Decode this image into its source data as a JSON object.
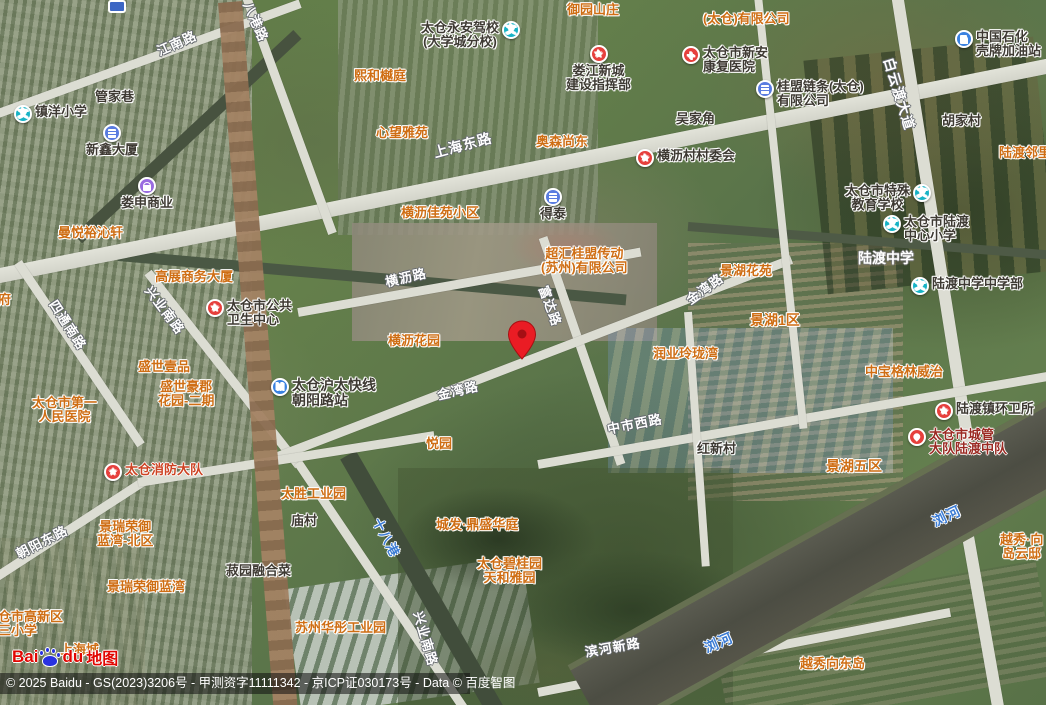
{
  "app": "baidu-maps-satellite",
  "attribution": {
    "text": "© 2025 Baidu - GS(2023)3206号 - 甲测资字11111342 - 京ICP证030173号 - Data © 百度智图"
  },
  "logo": {
    "bai": "Bai",
    "du": "du",
    "map_word": "地图"
  },
  "colors": {
    "poi_orange": "#cf6e14",
    "poi_dark": "#3e3a33",
    "water_blue": "#3c7cd4",
    "icon_red": "#e6403d",
    "icon_teal": "#17b3c6",
    "icon_blue": "#3b82e0",
    "icon_purple": "#9a6ce0",
    "pin_red": "#ea1c24"
  },
  "pin": {
    "x": 507,
    "y": 320
  },
  "labels": [
    {
      "name": "jiangnan-road-label",
      "text": "江南路",
      "type": "road",
      "x": 155,
      "y": 46,
      "rotate": -24
    },
    {
      "name": "bagang-road-label",
      "text": "八港路",
      "type": "road",
      "x": 253,
      "y": 0,
      "rotate": 66
    },
    {
      "name": "shanghai-east-road-label",
      "text": "上海东路",
      "type": "road",
      "x": 432,
      "y": 146,
      "rotate": -15,
      "size": 14
    },
    {
      "name": "baiyundu-avenue-label",
      "text": "白云渡大道",
      "type": "road",
      "x": 895,
      "y": 56,
      "rotate": 73,
      "size": 14
    },
    {
      "name": "sitong-south-road-label",
      "text": "四通南路",
      "type": "road",
      "x": 58,
      "y": 298,
      "rotate": 57
    },
    {
      "name": "xingye-south-road-label",
      "text": "兴业南路",
      "type": "road",
      "x": 153,
      "y": 284,
      "rotate": 53
    },
    {
      "name": "hengli-road-label",
      "text": "横沥路",
      "type": "road",
      "x": 384,
      "y": 276,
      "rotate": -13
    },
    {
      "name": "fuda-road-label",
      "text": "富达路",
      "type": "road",
      "x": 549,
      "y": 284,
      "rotate": 70
    },
    {
      "name": "jinwan-road-west-label",
      "text": "金湾路",
      "type": "road",
      "x": 436,
      "y": 389,
      "rotate": -13
    },
    {
      "name": "jinwan-road-east-label",
      "text": "金湾路",
      "type": "road",
      "x": 684,
      "y": 296,
      "rotate": -36
    },
    {
      "name": "zhongshi-west-road-label",
      "text": "中市西路",
      "type": "road",
      "x": 606,
      "y": 423,
      "rotate": -11
    },
    {
      "name": "chaoyang-east-road-label",
      "text": "朝阳东路",
      "type": "road",
      "x": 14,
      "y": 549,
      "rotate": -27
    },
    {
      "name": "xingye-south-road-2-label",
      "text": "兴业南路",
      "type": "road",
      "x": 424,
      "y": 610,
      "rotate": 74
    },
    {
      "name": "binhe-new-road-label",
      "text": "滨河新路",
      "type": "road",
      "x": 584,
      "y": 646,
      "rotate": -10
    },
    {
      "name": "shibagang-waterway-label",
      "text": "十八港",
      "type": "water",
      "x": 382,
      "y": 516,
      "rotate": 62
    },
    {
      "name": "liuhe-river-east-label",
      "text": "浏河",
      "type": "water",
      "x": 930,
      "y": 516,
      "rotate": -25,
      "size": 14
    },
    {
      "name": "liuhe-river-west-label",
      "text": "浏河",
      "type": "water",
      "x": 702,
      "y": 642,
      "rotate": -23,
      "size": 14
    },
    {
      "name": "yuyuan-shanzhuang",
      "text": "御园山庄",
      "type": "poi-orange",
      "x": 567,
      "y": 3
    },
    {
      "name": "taicang-co-ltd",
      "text": "(太仓)有限公司",
      "type": "poi-orange",
      "x": 703,
      "y": 12
    },
    {
      "name": "xihe-yueting",
      "text": "熙和樾庭",
      "type": "poi-orange",
      "x": 354,
      "y": 69
    },
    {
      "name": "xinwang-yayuan",
      "text": "心望雅苑",
      "type": "poi-orange",
      "x": 376,
      "y": 126
    },
    {
      "name": "aosen-shangdong",
      "text": "奥森尚东",
      "type": "poi-orange",
      "x": 536,
      "y": 135
    },
    {
      "name": "hengli-jiayuan-block",
      "text": "横沥佳苑小区",
      "type": "poi-orange",
      "x": 401,
      "y": 206
    },
    {
      "name": "chaohui-guimeng-company",
      "text": "超汇桂盟传动\n(苏州)有限公司",
      "type": "poi-orange",
      "x": 541,
      "y": 247,
      "align": "center"
    },
    {
      "name": "hengli-garden",
      "text": "横沥花园",
      "type": "poi-orange",
      "x": 388,
      "y": 334
    },
    {
      "name": "manyue-yuqinxuan",
      "text": "曼悦裕沁轩",
      "type": "poi-orange",
      "x": 58,
      "y": 226
    },
    {
      "name": "gaozhan-business-tower",
      "text": "高展商务大厦",
      "type": "poi-orange",
      "x": 155,
      "y": 270
    },
    {
      "name": "shengshi-yipin",
      "text": "盛世壹品",
      "type": "poi-orange",
      "x": 138,
      "y": 360
    },
    {
      "name": "shengshi-haojun-garden",
      "text": "盛世豪郡\n花园-二期",
      "type": "poi-orange",
      "x": 158,
      "y": 380,
      "align": "center"
    },
    {
      "name": "taicang-first-hospital",
      "text": "太仓市第一\n人民医院",
      "type": "poi-orange",
      "x": 32,
      "y": 396,
      "align": "center"
    },
    {
      "name": "jinghu-huayuan",
      "text": "景湖花苑",
      "type": "poi-orange",
      "x": 720,
      "y": 264
    },
    {
      "name": "jinghu-zone-1",
      "text": "景湖1区",
      "type": "poi-orange",
      "x": 750,
      "y": 313,
      "size": 14
    },
    {
      "name": "runye-linglongwan",
      "text": "润业玲珑湾",
      "type": "poi-orange",
      "x": 653,
      "y": 347
    },
    {
      "name": "zhongbao-greenwich",
      "text": "中宝格林威治",
      "type": "poi-orange",
      "x": 865,
      "y": 365
    },
    {
      "name": "jinghu-zone-5",
      "text": "景湖五区",
      "type": "poi-orange",
      "x": 826,
      "y": 459,
      "size": 14
    },
    {
      "name": "yueyuan",
      "text": "悦园",
      "type": "poi-orange",
      "x": 426,
      "y": 437
    },
    {
      "name": "taisheng-industrial-park",
      "text": "太胜工业园",
      "type": "poi-orange",
      "x": 281,
      "y": 487
    },
    {
      "name": "chengfa-dingsheng-huating",
      "text": "城发·鼎盛华庭",
      "type": "poi-orange",
      "x": 436,
      "y": 518
    },
    {
      "name": "taicang-biguiyuan",
      "text": "太仓碧桂园\n天和雅园",
      "type": "poi-orange",
      "x": 477,
      "y": 557,
      "align": "center"
    },
    {
      "name": "suzhou-huatong-industrial-park",
      "text": "苏州华彤工业园",
      "type": "poi-orange",
      "x": 295,
      "y": 621
    },
    {
      "name": "jingrui-lanwan-north",
      "text": "景瑞荣御\n蓝湾-北区",
      "type": "poi-orange",
      "x": 97,
      "y": 520,
      "align": "center"
    },
    {
      "name": "jingrui-lanwan",
      "text": "景瑞荣御蓝湾",
      "type": "poi-orange",
      "x": 107,
      "y": 580
    },
    {
      "name": "gaoxin-third-primary-school",
      "text": "太仓市高新区\n第三小学",
      "type": "poi-orange",
      "x": -15,
      "y": 610
    },
    {
      "name": "shanghai-cheng",
      "text": "上海城",
      "type": "poi-orange",
      "x": 60,
      "y": 643
    },
    {
      "name": "ludu-linli",
      "text": "陆渡邻里",
      "type": "poi-orange",
      "x": 999,
      "y": 146
    },
    {
      "name": "yuexiu-daoyundi",
      "text": "越秀·向\n岛云邸",
      "type": "poi-orange",
      "x": 1000,
      "y": 533,
      "align": "center"
    },
    {
      "name": "yuexiu-xiangdongdao",
      "text": "越秀向东岛",
      "type": "poi-orange",
      "x": 800,
      "y": 657
    },
    {
      "name": "fu-partial-label",
      "text": "府",
      "type": "poi-orange",
      "x": -2,
      "y": 293
    },
    {
      "name": "taicang-fire-brigade",
      "text": "太仓消防大队",
      "type": "poi-redorange",
      "x": 104,
      "y": 463,
      "icon": "fire",
      "icon_pos": "left"
    },
    {
      "name": "guanjia-lane",
      "text": "管家巷",
      "type": "poi-dark",
      "x": 95,
      "y": 90
    },
    {
      "name": "zhenyang-primary-school",
      "text": "镇洋小学",
      "type": "poi-dark",
      "x": 14,
      "y": 105,
      "icon": "school",
      "icon_pos": "left"
    },
    {
      "name": "xinxin-tower",
      "text": "新鑫大厦",
      "type": "poi-dark",
      "x": 86,
      "y": 124,
      "icon": "building",
      "icon_pos": "top",
      "align": "center"
    },
    {
      "name": "loushen-commercial",
      "text": "娄申商业",
      "type": "poi-dark",
      "x": 121,
      "y": 177,
      "icon": "shop",
      "icon_pos": "top",
      "align": "center"
    },
    {
      "name": "wujia-jiao",
      "text": "吴家角",
      "type": "poi-dark",
      "x": 676,
      "y": 112
    },
    {
      "name": "hujia-village",
      "text": "胡家村",
      "type": "poi-dark",
      "x": 942,
      "y": 114
    },
    {
      "name": "miao-village",
      "text": "庙村",
      "type": "poi-dark",
      "x": 291,
      "y": 514
    },
    {
      "name": "hongxin-village",
      "text": "红新村",
      "type": "poi-dark",
      "x": 697,
      "y": 442
    },
    {
      "name": "shuyuan-ronghecai",
      "text": "菽园融合菜",
      "type": "poi-dark",
      "x": 226,
      "y": 564
    },
    {
      "name": "taicang-yongan-driving-school",
      "text": "太仓永安驾校\n(大学城分校)",
      "type": "poi-dark",
      "x": 421,
      "y": 21,
      "icon": "school",
      "icon_pos": "right",
      "align": "center"
    },
    {
      "name": "loujiang-new-city-hq",
      "text": "娄江新城\n建设指挥部",
      "type": "poi-dark",
      "x": 566,
      "y": 45,
      "icon": "star",
      "icon_pos": "top",
      "align": "center"
    },
    {
      "name": "xinan-rehab-hospital",
      "text": "太仓市新安\n康复医院",
      "type": "poi-dark",
      "x": 682,
      "y": 46,
      "icon": "hospital",
      "icon_pos": "left"
    },
    {
      "name": "guimeng-chain-company",
      "text": "桂盟链条(太仓)\n有限公司",
      "type": "poi-dark",
      "x": 756,
      "y": 80,
      "icon": "building",
      "icon_pos": "left"
    },
    {
      "name": "sinopec-shell-gas-station",
      "text": "中国石化\n壳牌加油站",
      "type": "poi-dark",
      "x": 955,
      "y": 30,
      "icon": "gas",
      "icon_pos": "left"
    },
    {
      "name": "hengli-village-committee",
      "text": "横沥村村委会",
      "type": "poi-dark",
      "x": 636,
      "y": 149,
      "icon": "star",
      "icon_pos": "left"
    },
    {
      "name": "detai",
      "text": "得泰",
      "type": "poi-dark",
      "x": 540,
      "y": 188,
      "icon": "building",
      "icon_pos": "top",
      "align": "center"
    },
    {
      "name": "public-health-center",
      "text": "太仓市公共\n卫生中心",
      "type": "poi-dark",
      "x": 206,
      "y": 299,
      "icon": "star",
      "icon_pos": "left"
    },
    {
      "name": "hutai-express-chaoyang-station",
      "text": "太仓沪太快线\n朝阳路站",
      "type": "poi-dark",
      "x": 271,
      "y": 378,
      "icon": "metro",
      "icon_pos": "left",
      "size": 14
    },
    {
      "name": "special-education-school",
      "text": "太仓市特殊\n教育学校",
      "type": "poi-dark",
      "x": 845,
      "y": 184,
      "icon": "school",
      "icon_pos": "right",
      "align": "center"
    },
    {
      "name": "ludu-central-primary-school",
      "text": "太仓市陆渡\n中心小学",
      "type": "poi-dark",
      "x": 883,
      "y": 215,
      "icon": "school",
      "icon_pos": "left"
    },
    {
      "name": "ludu-middle-school-area",
      "text": "陆渡中学",
      "type": "poi-white",
      "x": 858,
      "y": 251,
      "size": 14
    },
    {
      "name": "ludu-middle-school-dept",
      "text": "陆渡中学中学部",
      "type": "poi-dark",
      "x": 911,
      "y": 277,
      "icon": "school",
      "icon_pos": "left"
    },
    {
      "name": "ludu-sanitation-office",
      "text": "陆渡镇环卫所",
      "type": "poi-dark",
      "x": 935,
      "y": 402,
      "icon": "star",
      "icon_pos": "left"
    },
    {
      "name": "chengguan-ludu-squadron",
      "text": "太仓市城管\n大队陆渡中队",
      "type": "poi-maroon",
      "x": 908,
      "y": 428,
      "icon": "redpin",
      "icon_pos": "left"
    }
  ]
}
